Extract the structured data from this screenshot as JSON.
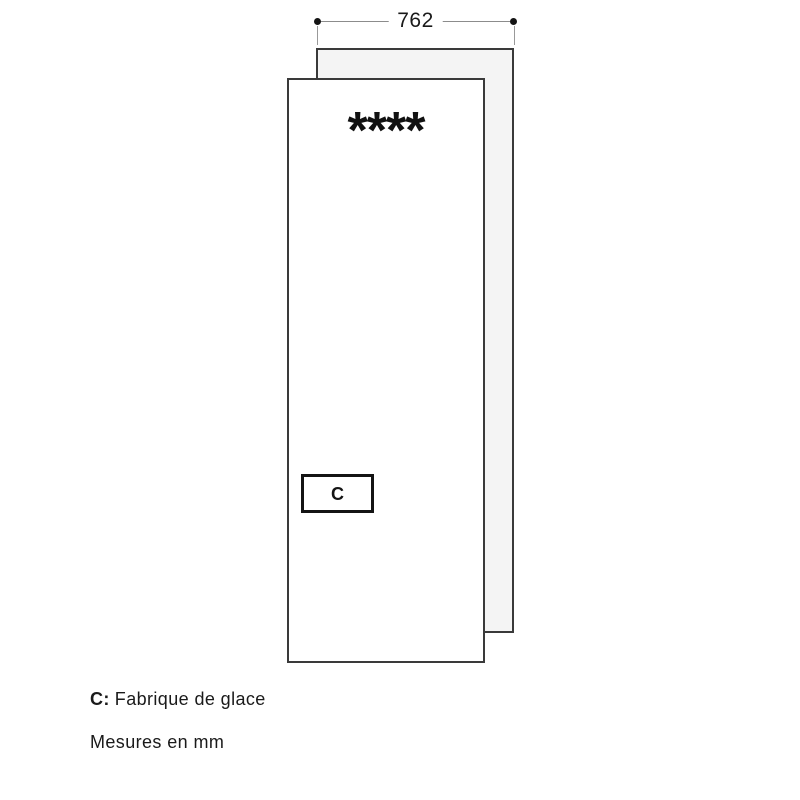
{
  "dimension": {
    "width_label": "762"
  },
  "door": {
    "stars_label": "****",
    "callout_label": "C"
  },
  "legend": {
    "c_key": "C:",
    "c_text": "Fabrique de glace",
    "units_note": "Mesures en mm"
  },
  "colors": {
    "panel_border": "#3a3a3a",
    "back_panel_fill": "#f4f4f4",
    "front_panel_fill": "#ffffff",
    "dimension_line": "#8c8c8c",
    "dimension_dot": "#141414",
    "text": "#1a1a1a"
  }
}
